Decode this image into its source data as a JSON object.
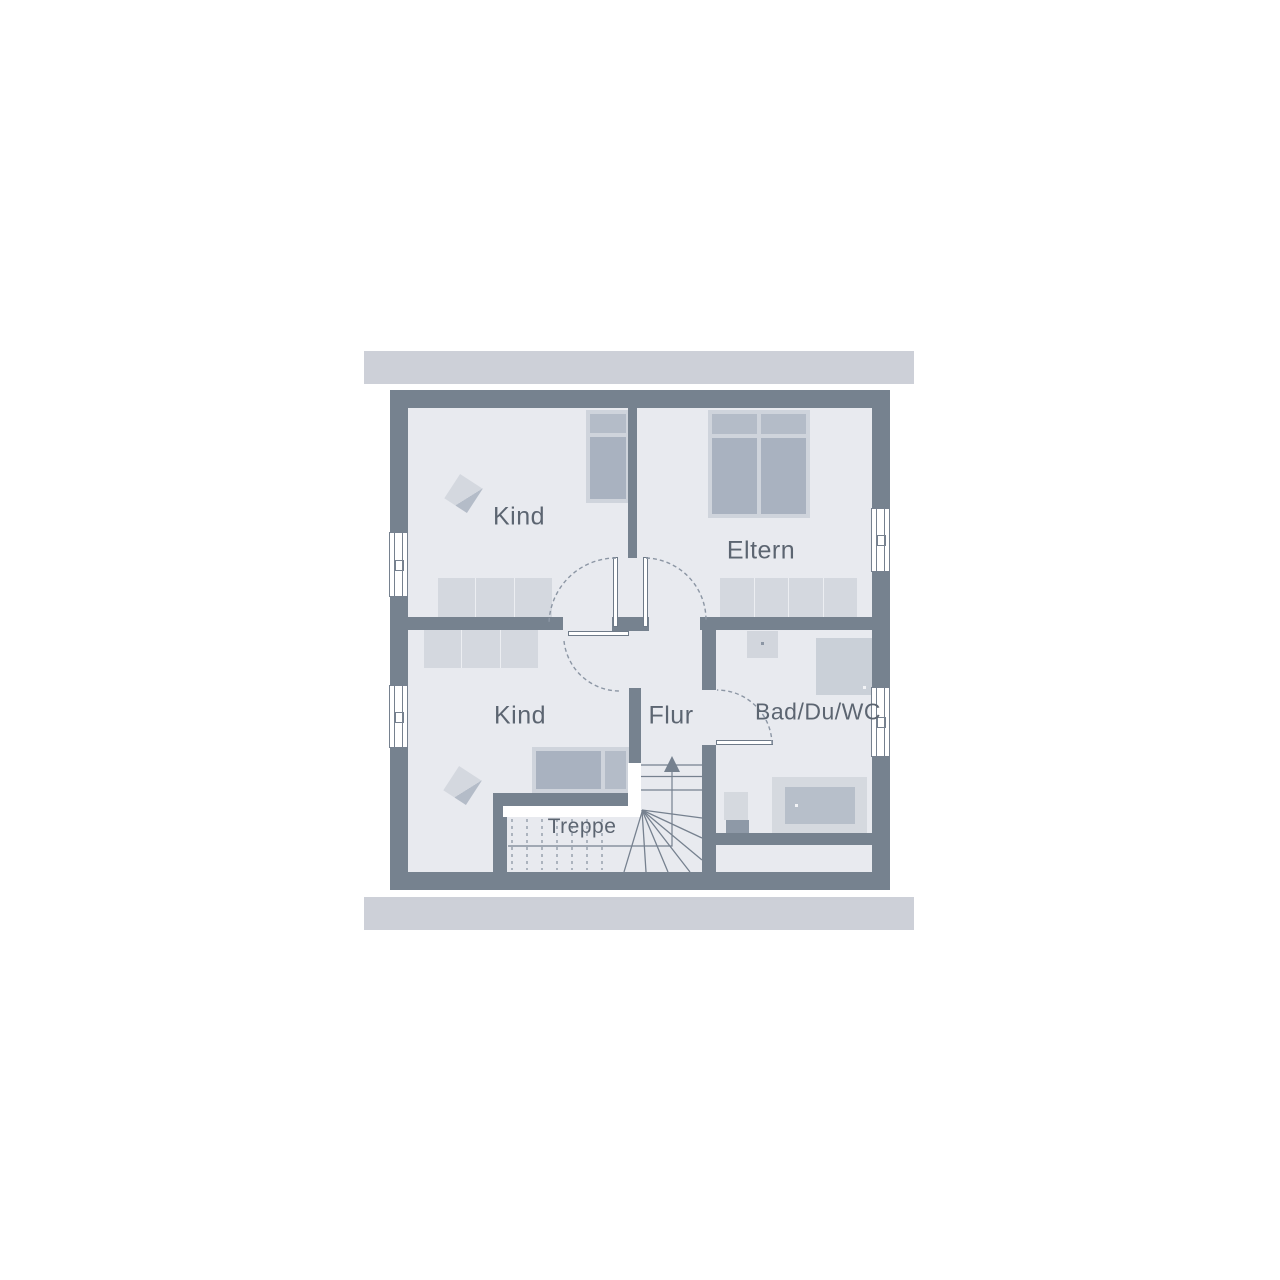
{
  "plan": {
    "type": "floor-plan",
    "rooms": [
      {
        "name": "kind-top",
        "label": "Kind"
      },
      {
        "name": "eltern",
        "label": "Eltern"
      },
      {
        "name": "kind-bottom",
        "label": "Kind"
      },
      {
        "name": "flur",
        "label": "Flur"
      },
      {
        "name": "bad-du-wc",
        "label": "Bad/Du/WC"
      },
      {
        "name": "treppe",
        "label": "Treppe"
      }
    ],
    "features": {
      "windows_left": 2,
      "windows_right": 2,
      "doors": 4,
      "stair_direction": "up"
    },
    "colors": {
      "background": "#ffffff",
      "roof_band": "#cdd0d8",
      "wall": "#76828f",
      "floor": "#e8eaef",
      "furniture_light": "#d4d8df",
      "furniture_mid": "#a9b2c0",
      "fixture_inner": "#b7bfca",
      "line": "#76818f",
      "dashed_line": "#8c96a4",
      "text": "#5c6571"
    }
  }
}
